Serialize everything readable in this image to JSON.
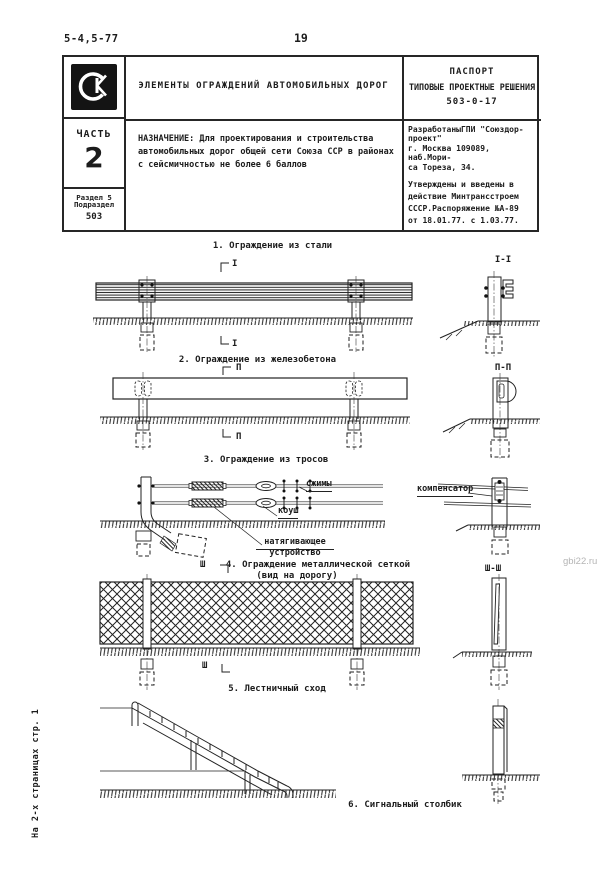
{
  "page": {
    "doc_number": "5-4,5-77",
    "page_number": "19",
    "side_note": "На 2-х страницах стр. 1",
    "watermark": "gbi22.ru",
    "ink_color": "#1c1c1c",
    "paper_color": "#ffffff",
    "watermark_color": "#b5b5b5"
  },
  "header": {
    "logo_monogram": "СК",
    "title": "ЭЛЕМЕНТЫ ОГРАЖДЕНИЙ АВТОМОБИЛЬНЫХ ДОРОГ",
    "passport_line1": "ПАСПОРТ",
    "passport_line2": "ТИПОВЫЕ ПРОЕКТНЫЕ РЕШЕНИЯ",
    "passport_number": "503-0-17",
    "part_label": "ЧАСТЬ",
    "part_number": "2",
    "section_line1": "Раздел 5",
    "section_line2": "Подраздел",
    "section_code": "503",
    "purpose": "НАЗНАЧЕНИЕ: Для проектирования и строительства\nавтомобильных дорог общей сети Союза ССР в районах\nс сейсмичностью не более 6 баллов",
    "developed_by": "РазработаныГПИ \"Союздор-\nпроект\"\nг. Москва 109089, наб.Мори-\nса Тореза, 34.",
    "approved": "Утверждены и  введены в\nдействие Минтрансстроем\nСССР.Распоряжение №А-89\nот 18.01.77. с 1.03.77."
  },
  "figures": {
    "fig1": {
      "caption": "1. Ограждение из стали",
      "cut_mark": "I",
      "section_title": "I-I"
    },
    "fig2": {
      "caption": "2. Ограждение из железобетона",
      "cut_mark": "П",
      "section_title": "П-П"
    },
    "fig3": {
      "caption": "3. Ограждение из тросов",
      "label_clamps": "сжимы",
      "label_thimble": "коуш",
      "label_tensioner_line1": "натягивающее",
      "label_tensioner_line2": "устройство",
      "label_compensator": "компенсатор"
    },
    "fig4": {
      "caption_line1": "4. Ограждение металлической сеткой",
      "caption_line2": "(вид на дорогу)",
      "cut_mark": "Ш",
      "section_title": "Ш-Ш"
    },
    "fig5": {
      "caption": "5. Лестничный сход"
    },
    "fig6": {
      "caption": "6. Сигнальный столбик"
    }
  }
}
